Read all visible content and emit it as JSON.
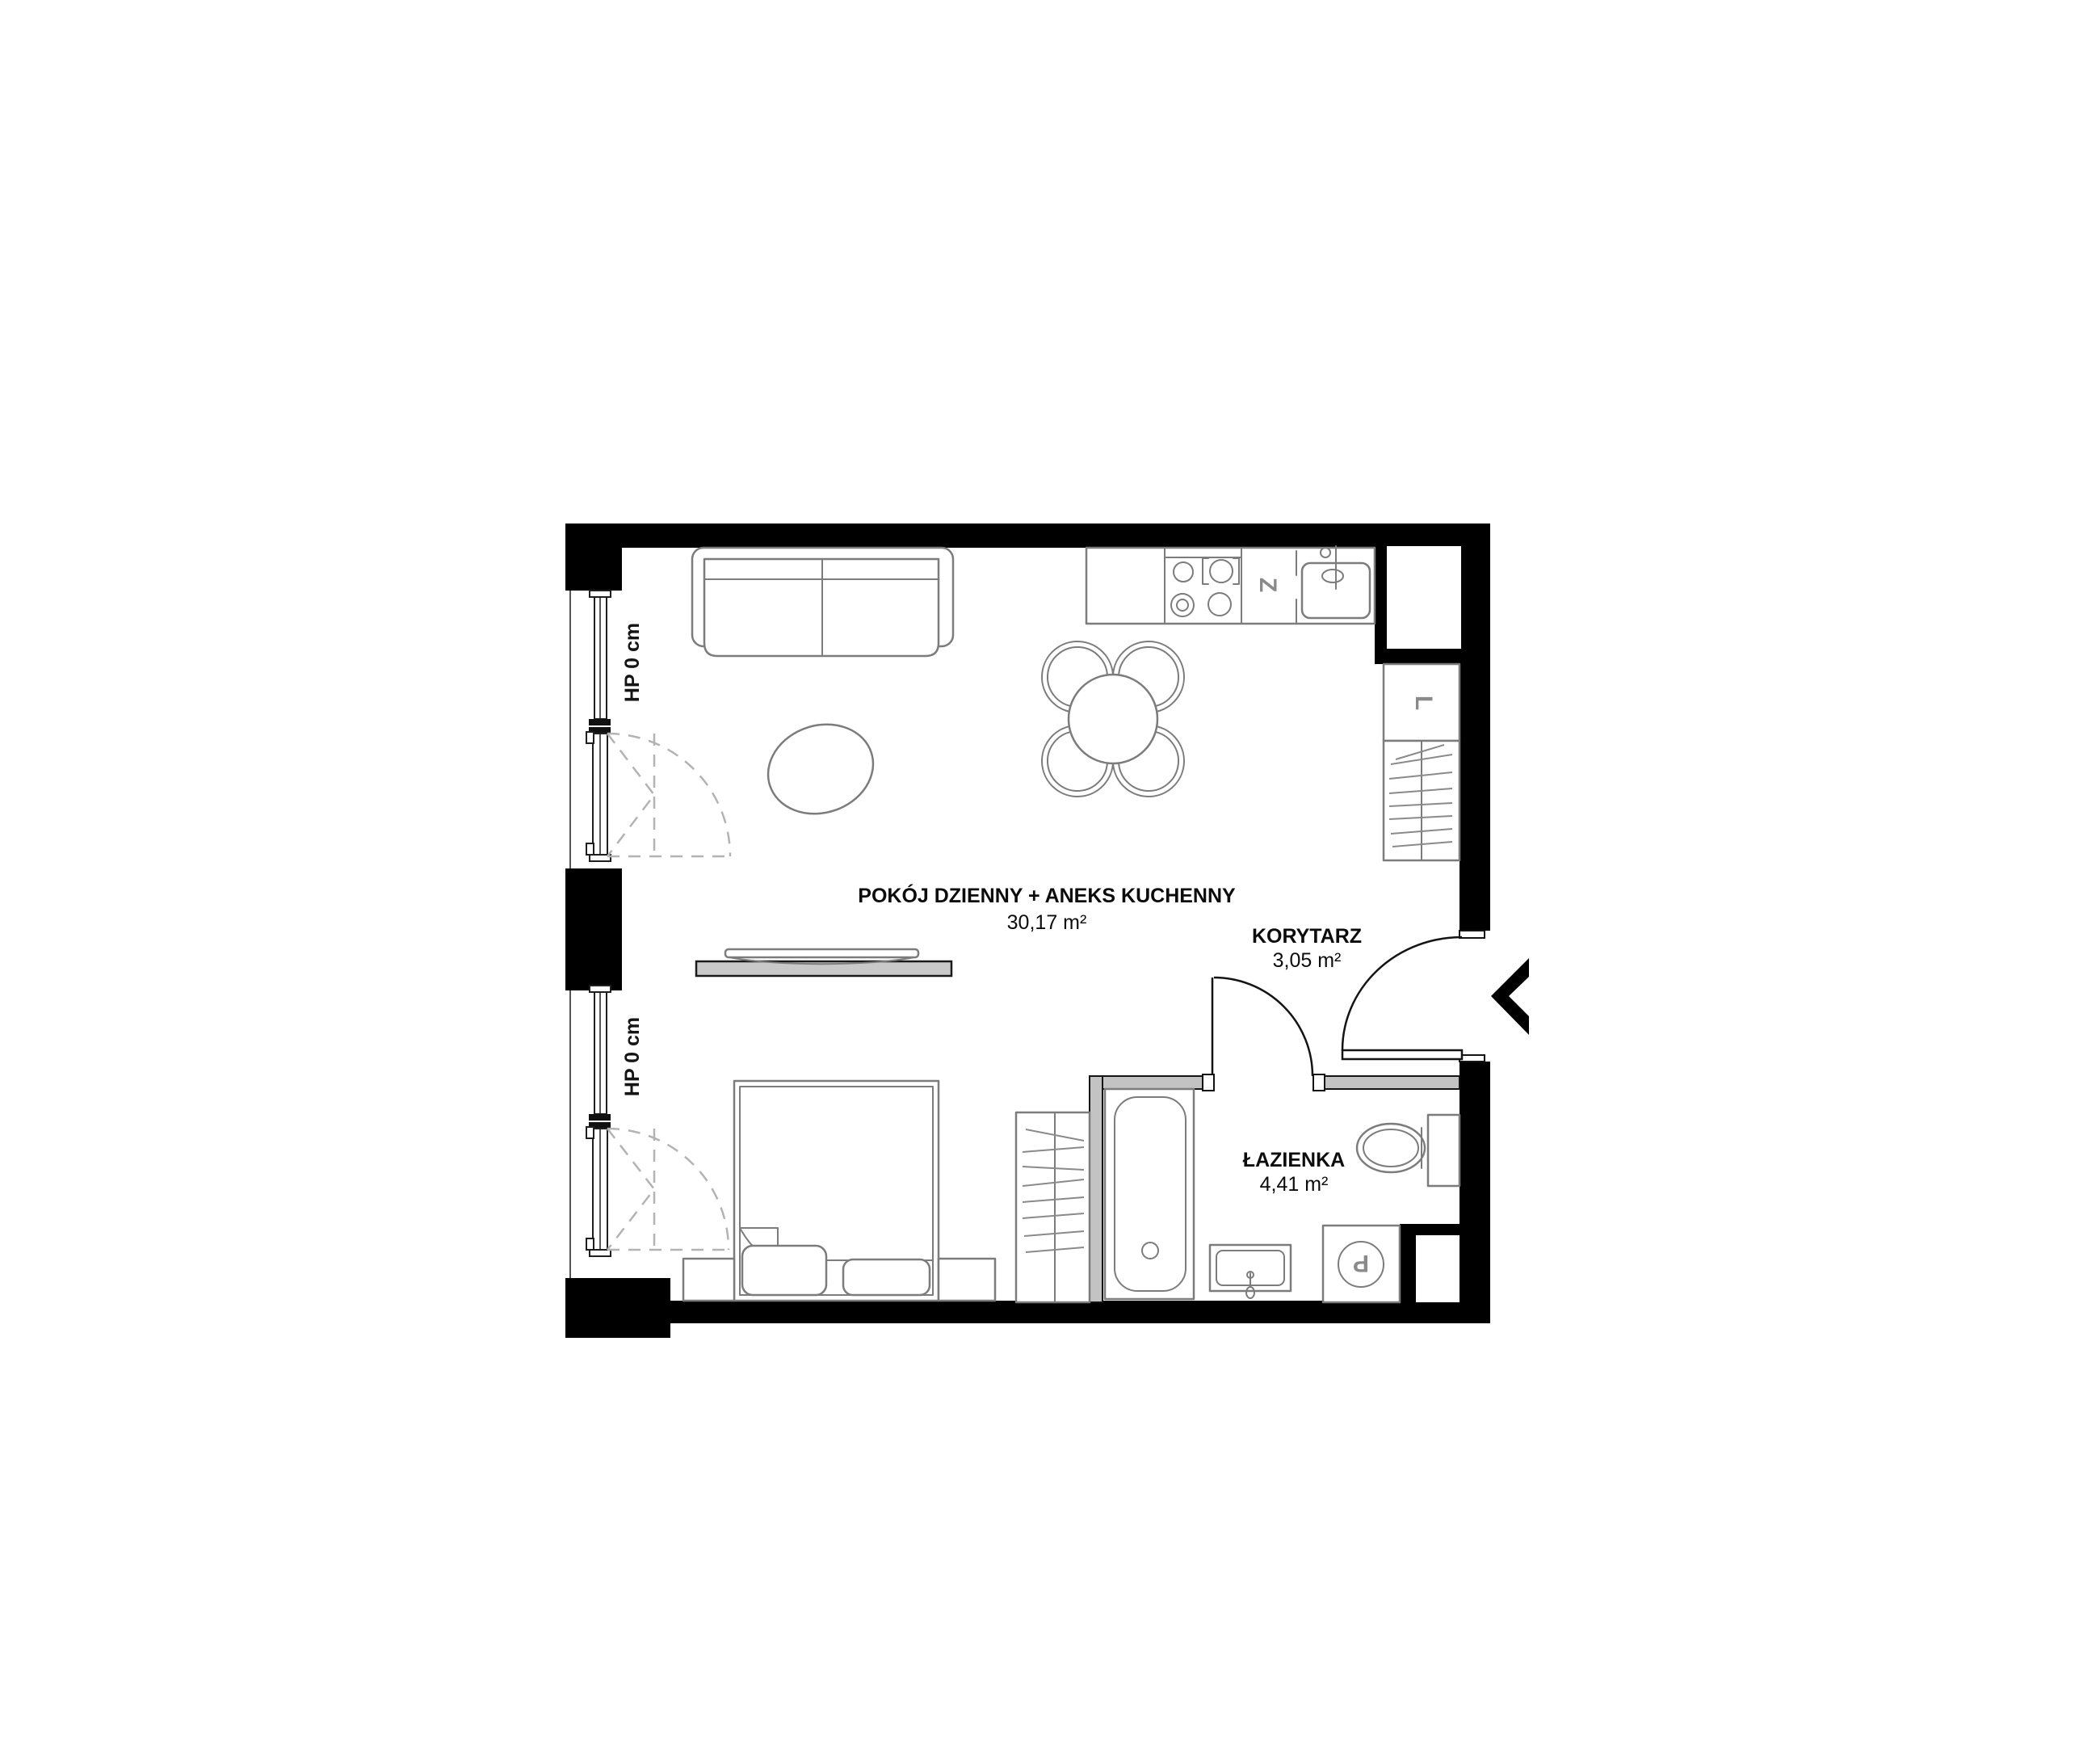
{
  "floorplan": {
    "rooms": [
      {
        "id": "living-kitchen",
        "name": "POKÓJ DZIENNY + ANEKS KUCHENNY",
        "area": "30,17 m²"
      },
      {
        "id": "corridor",
        "name": "KORYTARZ",
        "area": "3,05 m²"
      },
      {
        "id": "bathroom",
        "name": "ŁAZIENKA",
        "area": "4,41 m²"
      }
    ],
    "windows": [
      {
        "id": "window-upper",
        "label": "HP 0 cm"
      },
      {
        "id": "window-lower",
        "label": "HP 0 cm"
      }
    ],
    "appliance_marks": {
      "dishwasher": "Z",
      "fridge": "L",
      "washing_machine": "P"
    },
    "colors": {
      "wall": "#000000",
      "partition_fill": "#c3c3c3",
      "furniture_stroke": "#7c7c7c",
      "sideboard_fill": "#c9c9c9",
      "dashed_stroke": "#b3b3b3",
      "text": "#0c0c0c"
    }
  }
}
